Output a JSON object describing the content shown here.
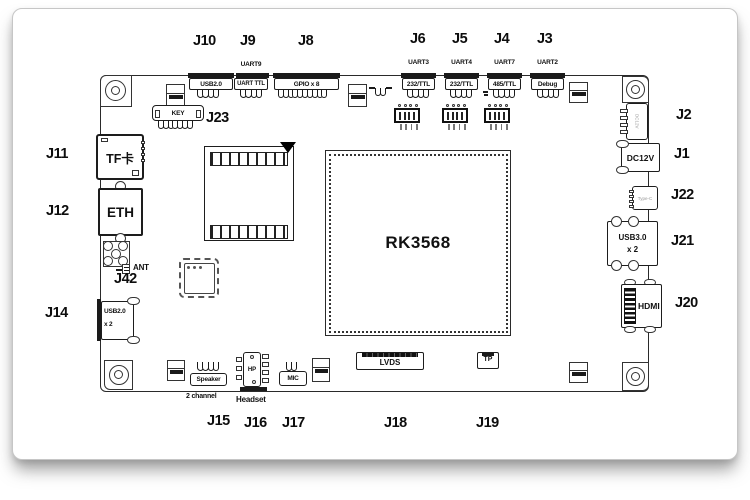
{
  "chip": {
    "name": "RK3568"
  },
  "refs": {
    "j1": "J1",
    "j2": "J2",
    "j3": "J3",
    "j4": "J4",
    "j5": "J5",
    "j6": "J6",
    "j8": "J8",
    "j9": "J9",
    "j10": "J10",
    "j11": "J11",
    "j12": "J12",
    "j14": "J14",
    "j15": "J15",
    "j16": "J16",
    "j17": "J17",
    "j18": "J18",
    "j19": "J19",
    "j20": "J20",
    "j21": "J21",
    "j22": "J22",
    "j23": "J23",
    "j42": "J42"
  },
  "top_connectors": {
    "usb2": {
      "ref": "J10",
      "label": "USB2.0"
    },
    "uart9": {
      "ref": "J9",
      "port": "UART9",
      "label": "UART TTL"
    },
    "gpio": {
      "ref": "J8",
      "label": "GPIO x 8"
    },
    "uart3": {
      "ref": "J6",
      "port": "UART3",
      "label": "232/TTL"
    },
    "uart4": {
      "ref": "J5",
      "port": "UART4",
      "label": "232/TTL"
    },
    "uart7": {
      "ref": "J4",
      "port": "UART7",
      "label": "485/TTL"
    },
    "uart2": {
      "ref": "J3",
      "port": "UART2",
      "label": "Debug"
    }
  },
  "left_connectors": {
    "tf": {
      "ref": "J11",
      "label": "TF卡"
    },
    "eth": {
      "ref": "J12",
      "label": "ETH"
    },
    "ant": {
      "ref": "J42",
      "label": "ANT"
    },
    "usb2x2": {
      "ref": "J14",
      "label": "USB2.0",
      "sub": "x 2"
    }
  },
  "right_connectors": {
    "j2conn": {
      "ref": "J2",
      "tiny": "DC12V"
    },
    "dc12v": {
      "ref": "J1",
      "label": "DC12V"
    },
    "typec": {
      "ref": "J22",
      "tiny": "Type-C"
    },
    "usb3": {
      "ref": "J21",
      "label": "USB3.0",
      "sub": "x 2"
    },
    "hdmi": {
      "ref": "J20",
      "label": "HDMI"
    }
  },
  "bottom_connectors": {
    "speaker": {
      "ref": "J15",
      "label": "Speaker",
      "sub": "2 channel"
    },
    "headset": {
      "ref": "J16",
      "label": "HP",
      "sub": "Headset"
    },
    "mic": {
      "ref": "J17",
      "label": "MIC"
    },
    "lvds": {
      "ref": "J18",
      "label": "LVDS"
    },
    "tp": {
      "ref": "J19",
      "label": "TP"
    }
  },
  "misc": {
    "key": {
      "ref": "J23",
      "label": "KEY"
    }
  }
}
